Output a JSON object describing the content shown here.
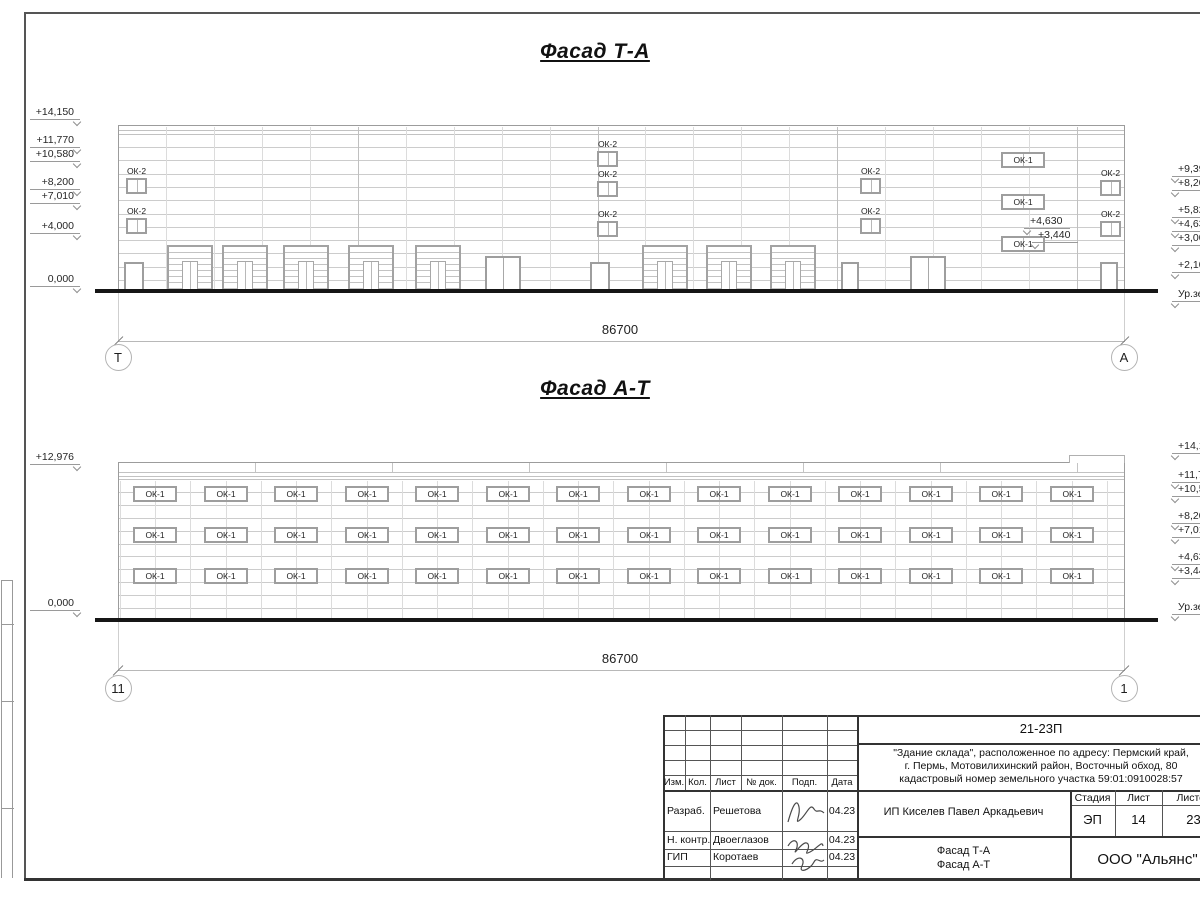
{
  "facade1": {
    "title": "Фасад Т-А",
    "dimension": "86700",
    "axis_left": "Т",
    "axis_right": "А",
    "left_marks": [
      "+14,150",
      "+11,770",
      "+10,580",
      "+8,200",
      "+7,010",
      "+4,000",
      "0,000"
    ],
    "right_marks": [
      "+9,39",
      "+8,20",
      "+5,82",
      "+4,63",
      "+3,00",
      "+2,10",
      "Ур.зе"
    ],
    "inner_marks": [
      "+4,630",
      "+3,440"
    ],
    "window_label_ok2": "ОК-2",
    "window_label_ok1": "ОК-1"
  },
  "facade2": {
    "title": "Фасад А-Т",
    "dimension": "86700",
    "axis_left": "11",
    "axis_right": "1",
    "left_marks": [
      "+12,976",
      "0,000"
    ],
    "right_marks": [
      "+14,15",
      "+11,77",
      "+10,58",
      "+8,20",
      "+7,01",
      "+4,63",
      "+3,44",
      "Ур.зе"
    ],
    "window_label": "ОК-1"
  },
  "titleblock": {
    "doc_number": "21-23П",
    "description_lines": [
      "\"Здание склада\", расположенное по адресу: Пермский край,",
      "г. Пермь, Мотовилихинский район, Восточный обход, 80",
      "кадастровый номер земельного участка 59:01:0910028:57"
    ],
    "client": "ИП Киселев Павел Аркадьевич",
    "stage_header": "Стадия",
    "sheet_header": "Лист",
    "sheets_header": "Листов",
    "stage": "ЭП",
    "sheet": "14",
    "sheets": "23",
    "drawing_name_lines": [
      "Фасад Т-А",
      "Фасад А-Т"
    ],
    "company": "ООО \"Альянс\"",
    "rev_headers": [
      "Изм.",
      "Кол.",
      "Лист",
      "№ док.",
      "Подп.",
      "Дата"
    ],
    "roles": [
      {
        "role": "Разраб.",
        "name": "Решетова",
        "date": "04.23"
      },
      {
        "role": "Н. контр.",
        "name": "Двоеглазов",
        "date": "04.23"
      },
      {
        "role": "ГИП",
        "name": "Коротаев",
        "date": "04.23"
      }
    ]
  }
}
